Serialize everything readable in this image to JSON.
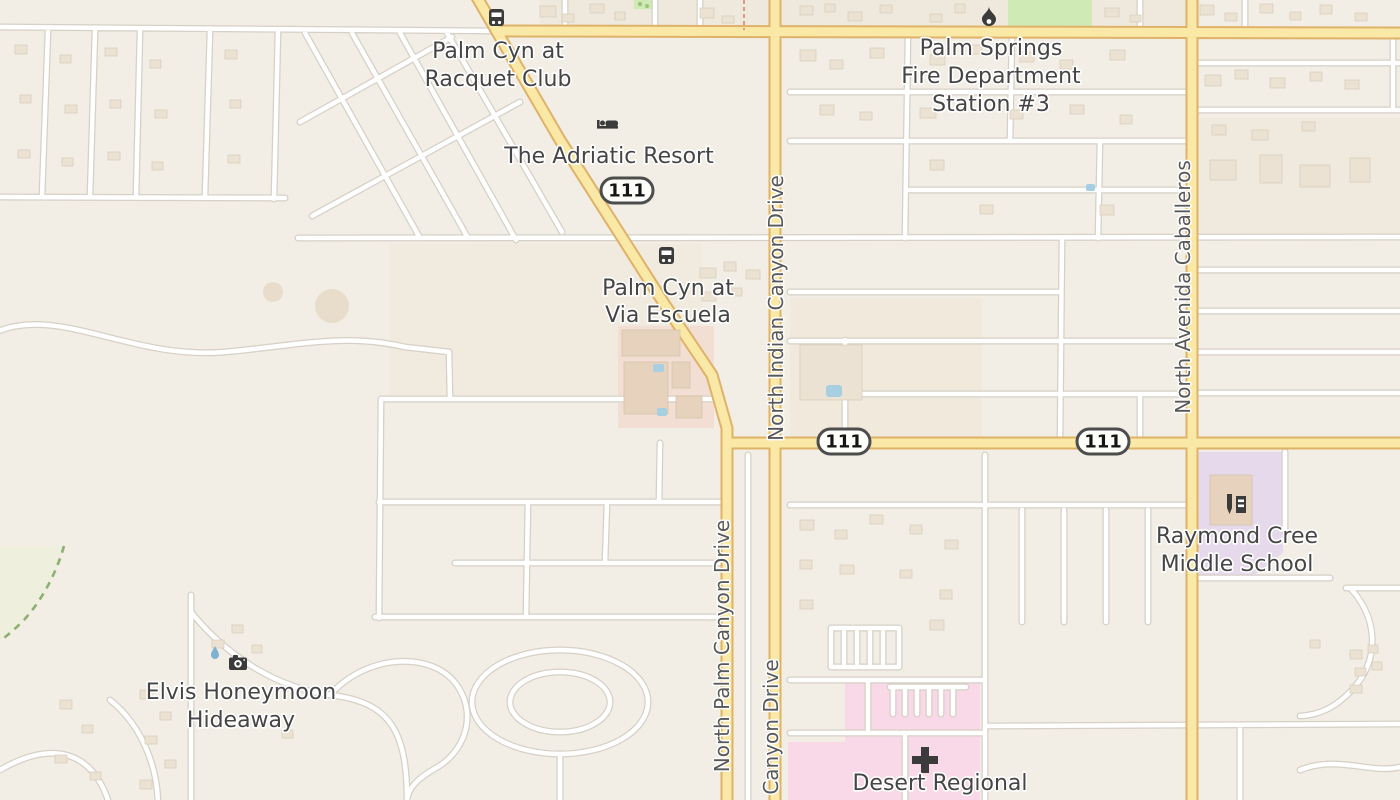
{
  "pois": {
    "racquet_club_stop": {
      "line1": "Palm Cyn at",
      "line2": "Racquet Club",
      "icon": "bus-icon"
    },
    "adriatic_resort": {
      "label": "The Adriatic Resort",
      "icon": "bed-icon"
    },
    "fire_station": {
      "line1": "Palm Springs",
      "line2": "Fire Department",
      "line3": "Station #3",
      "icon": "fire-icon"
    },
    "via_escuela_stop": {
      "line1": "Palm Cyn at",
      "line2": "Via Escuela",
      "icon": "bus-icon"
    },
    "middle_school": {
      "line1": "Raymond Cree",
      "line2": "Middle School",
      "icon": "school-icon"
    },
    "elvis_hideaway": {
      "line1": "Elvis Honeymoon",
      "line2": "Hideaway",
      "icon": "camera-icon"
    },
    "hospital": {
      "label": "Desert Regional",
      "icon": "hospital-cross-icon"
    }
  },
  "streets": {
    "palm_canyon": "North Palm Canyon Drive",
    "indian_canyon": "North Indian Canyon Drive",
    "indian_canyon_south": "Canyon Drive",
    "caballeros": "North Avenida Caballeros"
  },
  "route_shield": {
    "ref": "111"
  },
  "colors": {
    "background": "#f2eee5",
    "road_major_fill": "#fae8a6",
    "road_major_casing": "#dfb269",
    "road_minor_fill": "#ffffff",
    "road_minor_casing": "#d6d0c6",
    "hospital_area": "#f9d8e7",
    "school_area": "#e6d9ec",
    "park_green": "#cfeab4",
    "reserve_tint": "#eef0dd",
    "reserve_boundary": "#8fae72",
    "building_fill": "#ece2d4",
    "pool_blue": "#a6cfe2",
    "poi_icon": "#3b3b3b",
    "poi_label_text": "#454545",
    "street_label_text": "#585858"
  }
}
